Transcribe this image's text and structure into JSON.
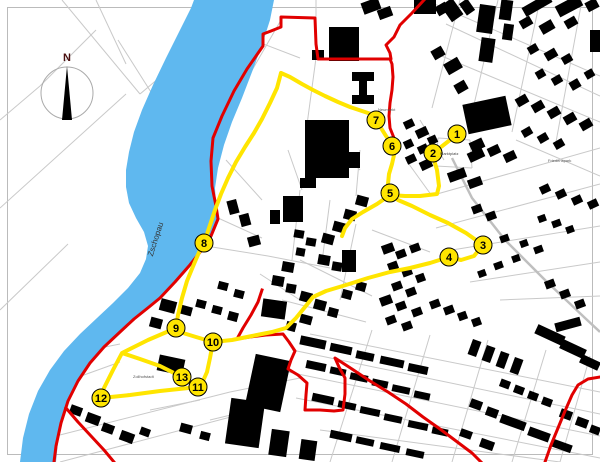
{
  "map": {
    "labels": {
      "river": "Zschopau",
      "marktplatz": "Marktplatz",
      "neumarkt": "Neumarkt",
      "friedenspark": "Friedenspark",
      "zollhofstadt": "Zollhofstadt",
      "compass_n": "N"
    },
    "waypoints": [
      {
        "n": "1",
        "x": 457,
        "y": 134
      },
      {
        "n": "2",
        "x": 433,
        "y": 153
      },
      {
        "n": "3",
        "x": 483,
        "y": 245
      },
      {
        "n": "4",
        "x": 449,
        "y": 257
      },
      {
        "n": "5",
        "x": 390,
        "y": 193
      },
      {
        "n": "6",
        "x": 392,
        "y": 146
      },
      {
        "n": "7",
        "x": 376,
        "y": 120
      },
      {
        "n": "8",
        "x": 204,
        "y": 243
      },
      {
        "n": "9",
        "x": 176,
        "y": 328
      },
      {
        "n": "10",
        "x": 213,
        "y": 342
      },
      {
        "n": "11",
        "x": 198,
        "y": 387
      },
      {
        "n": "12",
        "x": 101,
        "y": 398
      },
      {
        "n": "13",
        "x": 182,
        "y": 377
      }
    ],
    "colors": {
      "river": "#5FB8EF",
      "boundary": "#E10000",
      "route": "#FFE500",
      "building": "#000000",
      "street": "#C9C9C9",
      "compass_letter": "#4A0F0F"
    }
  }
}
